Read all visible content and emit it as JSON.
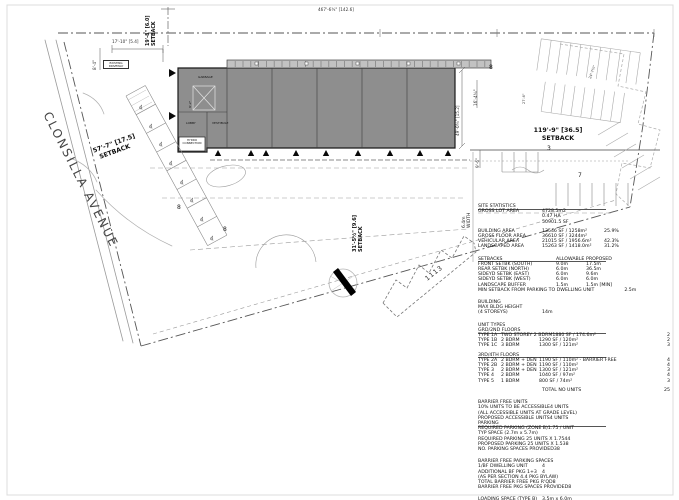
{
  "plan": {
    "street": "CLONSILLA AVENUE",
    "dim_top": "467'-6¾\" [142.6]",
    "setback_top": {
      "l1": "19'-8\" [6.0]",
      "l2": "SETBACK"
    },
    "setback_left": {
      "l1": "57'-7\" [17.5]",
      "l2": "SETBACK"
    },
    "setback_right": {
      "l1": "119'-9\" [36.5]",
      "l2": "SETBACK"
    },
    "setback_bottom": {
      "l1": "31'-5½\" [9.6]",
      "l2": "SETBACK"
    },
    "aisle_width": {
      "l1": "6.4m",
      "l2": "WIDTH"
    },
    "dims": {
      "bldg_right": "49'-0¾\" [15.2]",
      "d9_6": "9'-6\"",
      "d16_4": "16'-4¾\"",
      "d17_10": "17'-10\" [5.4]",
      "d8_4": "8'-4\"",
      "d24_7": "24'-7¾\"",
      "d27_6": "27'-6\""
    },
    "building_labels": {
      "garbage": "GARBAGE",
      "stair_dim": "9'-2\"",
      "lobby": "LOBBY",
      "vestibule": "VESTIBULE",
      "hydro": "HYDRO CONNECTION",
      "existing_driveway": "EXISTING DRIVEWAY"
    },
    "neighbor_number": "1113",
    "stall_counts": {
      "left_row": "8",
      "mid_row": "8",
      "canopy_end": "8",
      "right_row_3": "3",
      "right_row_7": "7"
    },
    "wheelchair_icon": "♿",
    "colors": {
      "building_fill": "#8e8e8e",
      "canopy_fill": "#c2c2c2",
      "line": "#555555"
    }
  },
  "stats": {
    "rows": [
      {
        "c1": "SITE STATISTICS",
        "cls": "u"
      },
      {
        "c1": "GROSS LOT AREA",
        "c2": "4728.5m2"
      },
      {
        "c2": "0.47 HA"
      },
      {
        "c2": "50901.5 SF"
      },
      {
        "c1": "BUILDING AREA",
        "c2": "13546 SF / 1258m²",
        "c3": "25.9%",
        "cls": "gap"
      },
      {
        "c1": "GROSS FLOOR AREA",
        "c2": "36610 SF / 3244m²"
      },
      {
        "c1": "VEHICULAR AREA",
        "c2": "21015 SF / 1956.6m²",
        "c3": "42.3%"
      },
      {
        "c1": "LANDSCAPED AREA",
        "c2": "15263 SF / 1418.0m²",
        "c3": "31.2%"
      },
      {
        "c1": "SETBACKS",
        "c2": "ALLOWABLE",
        "c3": "PROPOSED",
        "cls": "gap2 setb u"
      },
      {
        "c1": "FRONT SETBK (SOUTH)",
        "c2": "9.0m",
        "c3": "17.5m",
        "cls": "setb"
      },
      {
        "c1": "REAR SETBK (NORTH)",
        "c2": "6.0m",
        "c3": "36.5m",
        "cls": "setb"
      },
      {
        "c1": "SIDEYD SETBK (EAST)",
        "c2": "6.0m",
        "c3": "9.6m",
        "cls": "setb"
      },
      {
        "c1": "SIDEYD SETBK (WEST)",
        "c2": "6.0m",
        "c3": "6.0m",
        "cls": "setb"
      },
      {
        "c1": "LANDSCAPE BUFFER",
        "c2": "1.5m",
        "c3": "1.5m [MIN]",
        "cls": "setb"
      },
      {
        "c1": "MIN SETBACK FROM PARKING TO DWELLING UNIT",
        "c3": "2.5m",
        "cls": "setb"
      },
      {
        "c1": "BUILDING",
        "cls": "gap2"
      },
      {
        "c1": "MAX BLDG HEIGHT"
      },
      {
        "c1": "(4 STOREYS)",
        "c2": "14m"
      },
      {
        "c1": "UNIT TYPES",
        "cls": "gap2"
      },
      {
        "c1": "GRD/2ND FLOORS",
        "cls": "u"
      },
      {
        "c1": "TYPE 1A",
        "c2": "TWO STOREY 2 BDRM",
        "c3": "1880 SF / 174.6m²",
        "c4": "2",
        "cls": "unit"
      },
      {
        "c1": "TYPE 1B",
        "c2": "2 BDRM",
        "c3": "1290 SF / 120m²",
        "c4": "2",
        "cls": "unit"
      },
      {
        "c1": "TYPE 1C",
        "c2": "3 BDRM",
        "c3": "1300 SF / 121m²",
        "c4": "3",
        "cls": "unit"
      },
      {
        "c1": "3RD/4TH FLOORS",
        "cls": "gap u"
      },
      {
        "c1": "TYPE 2A",
        "c2": "2 BDRM + DEN",
        "c3": "1190 SF / 110m² - BARRIER FREE",
        "c4": "4",
        "cls": "unit"
      },
      {
        "c1": "TYPE 2B",
        "c2": "2 BDRM + DEN",
        "c3": "1190 SF / 110m²",
        "c4": "4",
        "cls": "unit"
      },
      {
        "c1": "TYPE 3",
        "c2": "2 BDRM + DEN",
        "c3": "1300 SF / 121m²",
        "c4": "3",
        "cls": "unit"
      },
      {
        "c1": "TYPE 4",
        "c2": "2 BDRM",
        "c3": "1040 SF / 97m²",
        "c4": "4",
        "cls": "unit"
      },
      {
        "c1": "TYPE 5",
        "c2": "1 BDRM",
        "c3": "800 SF / 74m²",
        "c4": "3",
        "cls": "unit"
      },
      {
        "c2": "TOTAL NO UNITS",
        "c4": "25",
        "cls": "gap"
      },
      {
        "c1": "BARRIER FREE UNITS",
        "cls": "gap2"
      },
      {
        "c1": "10% UNITS TO BE ACCESSIBLE",
        "c2": "4 UNITS"
      },
      {
        "c1": "(ALL ACCESSIBLE UNITS AT GRADE LEVEL)"
      },
      {
        "c1": "PROPOSED ACCESSIBLE UNITS",
        "c2": "4 UNITS"
      },
      {
        "c1": "PARKING",
        "cls": "u"
      },
      {
        "c1": "REQUIRED PARKING (ZONE B)",
        "c2": "1.75 / UNIT"
      },
      {
        "c1": "TYP SPACE (2.7m x 5.7m)"
      },
      {
        "c1": "REQUIRED PARKING 25 UNITS X 1.75",
        "c2": "44"
      },
      {
        "c1": "PROPOSED PARKING 25 UNITS X 1.5",
        "c2": "38"
      },
      {
        "c1": "NO. PARKING SPACES PROVIDED",
        "c2": "38"
      },
      {
        "c1": "BARRIER FREE PARKING SPACES",
        "cls": "gap2"
      },
      {
        "c1": "1/BF DWELLING UNIT",
        "c2": "4"
      },
      {
        "c1": "ADDITIONAL BF PKG 1+3",
        "c2": "4"
      },
      {
        "c1": "(AS PER SECTION 4.4 PKG BYLAW)"
      },
      {
        "c1": "TOTAL BARRIER FREE PKG R'QD",
        "c2": "8"
      },
      {
        "c1": "BARRIER FREE PKG SPACES PROVIDED",
        "c2": "8"
      },
      {
        "c1": "LOADING SPACE (TYPE B)",
        "c2": "3.5m x 6.0m",
        "cls": "gap2"
      }
    ]
  }
}
